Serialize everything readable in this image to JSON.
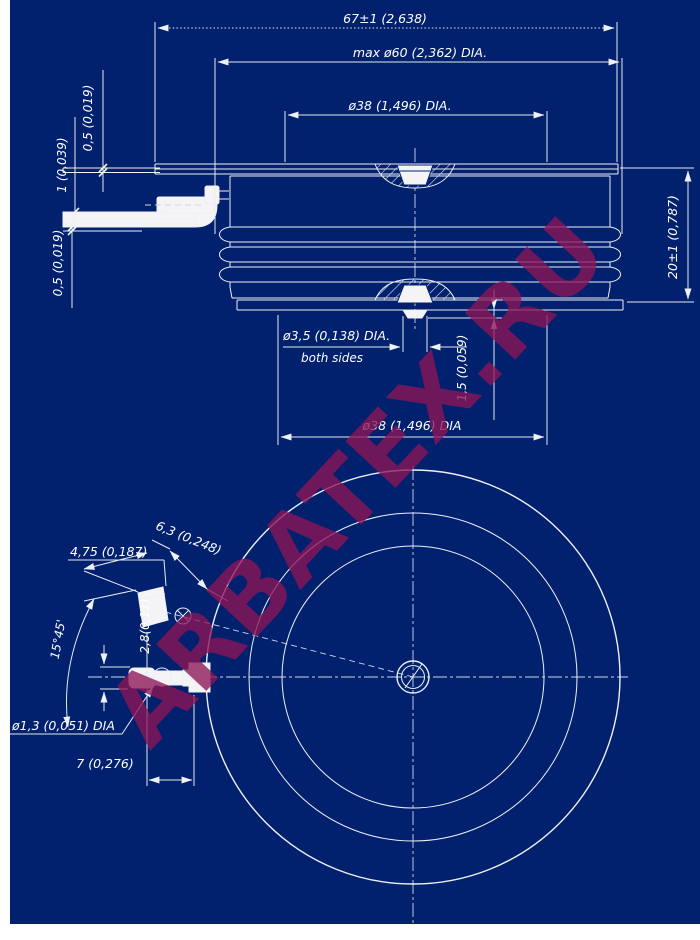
{
  "watermark": {
    "text": "ARBATEX.RU"
  },
  "colors": {
    "background": "#01216e",
    "line": "#eef0f5",
    "watermark": "#8d1556"
  },
  "side": {
    "overall_width": "67±1 (2,638)",
    "housing_dia": "max ø60 (2,362) DIA.",
    "top_pole_dia": "ø38 (1,496) DIA.",
    "lead_thk_a": "0,5 (0,019)",
    "lead_thk_b": "1 (0,039)",
    "lead_thk_c": "0,5 (0,019)",
    "height": "20±1 (0,787)",
    "center_recess_dia": "ø3,5 (0,138) DIA.",
    "center_recess_note": "both sides",
    "boss_height": "1,5 (0,059)",
    "bottom_pole_dia": "ø38 (1,496) DIA"
  },
  "plan": {
    "lug_width": "4,75 (0,187)",
    "hole_offset": "6,3 (0,248)",
    "lead_angle": "15°45'",
    "lug_thickness": "2,8(0,11)",
    "lead_hole_dia": "ø1,3 (0,051) DIA",
    "lug_length": "7 (0,276)"
  }
}
